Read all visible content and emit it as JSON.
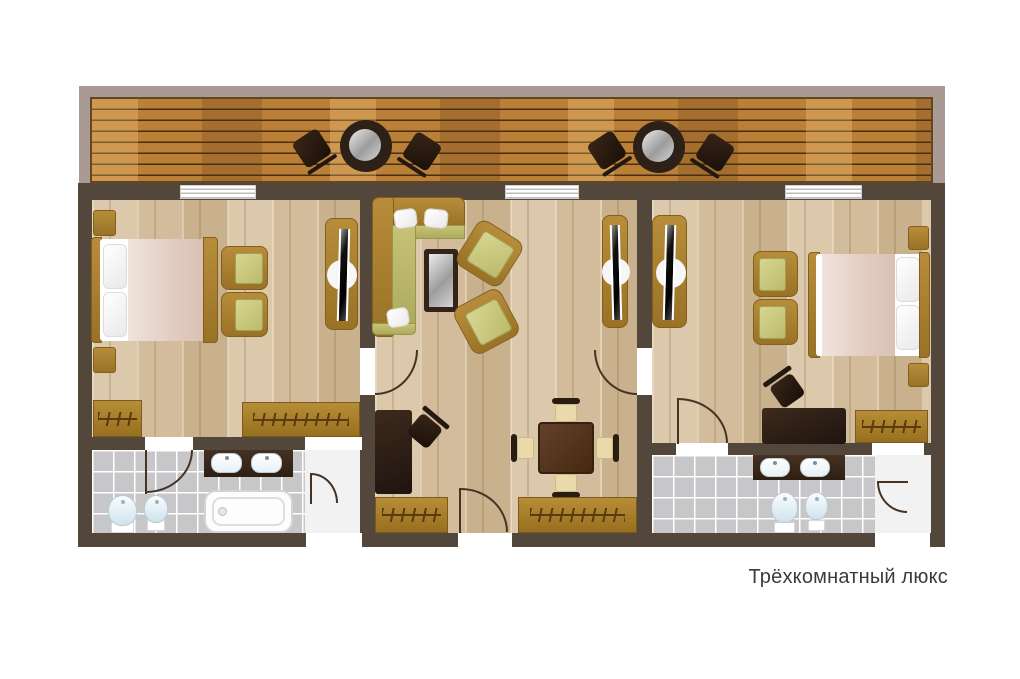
{
  "caption": {
    "text": "Трёхкомнатный люкс"
  },
  "palette": {
    "wall": "#53463a",
    "floor_wood": "#d7c2a4",
    "deck_wood": "#bb8038",
    "balcony_frame": "#a99a94",
    "tile_gray": "#c7c7c9",
    "furniture_brown": "#a8802e",
    "cushion_olive": "#c9c87d",
    "dark_wood": "#241810",
    "blanket_pink": "#e6d2c8",
    "door_line": "#453426",
    "caption_text": "#3b3b3b"
  },
  "inventory": {
    "balcony": [
      "patio table",
      "patio chairs"
    ],
    "bedroom_left": [
      "double bed",
      "nightstands",
      "armchairs",
      "tv console",
      "wardrobes"
    ],
    "living_room": [
      "corner sofa",
      "coffee table",
      "armchairs",
      "tv console",
      "dining table",
      "desk",
      "wardrobes"
    ],
    "bedroom_right": [
      "double bed",
      "nightstands",
      "armchairs",
      "tv console",
      "desk",
      "wardrobe"
    ],
    "bathroom_left": [
      "double vanity",
      "bathtub",
      "toilet",
      "bidet"
    ],
    "bathroom_right": [
      "double vanity",
      "toilet",
      "bidet"
    ]
  }
}
